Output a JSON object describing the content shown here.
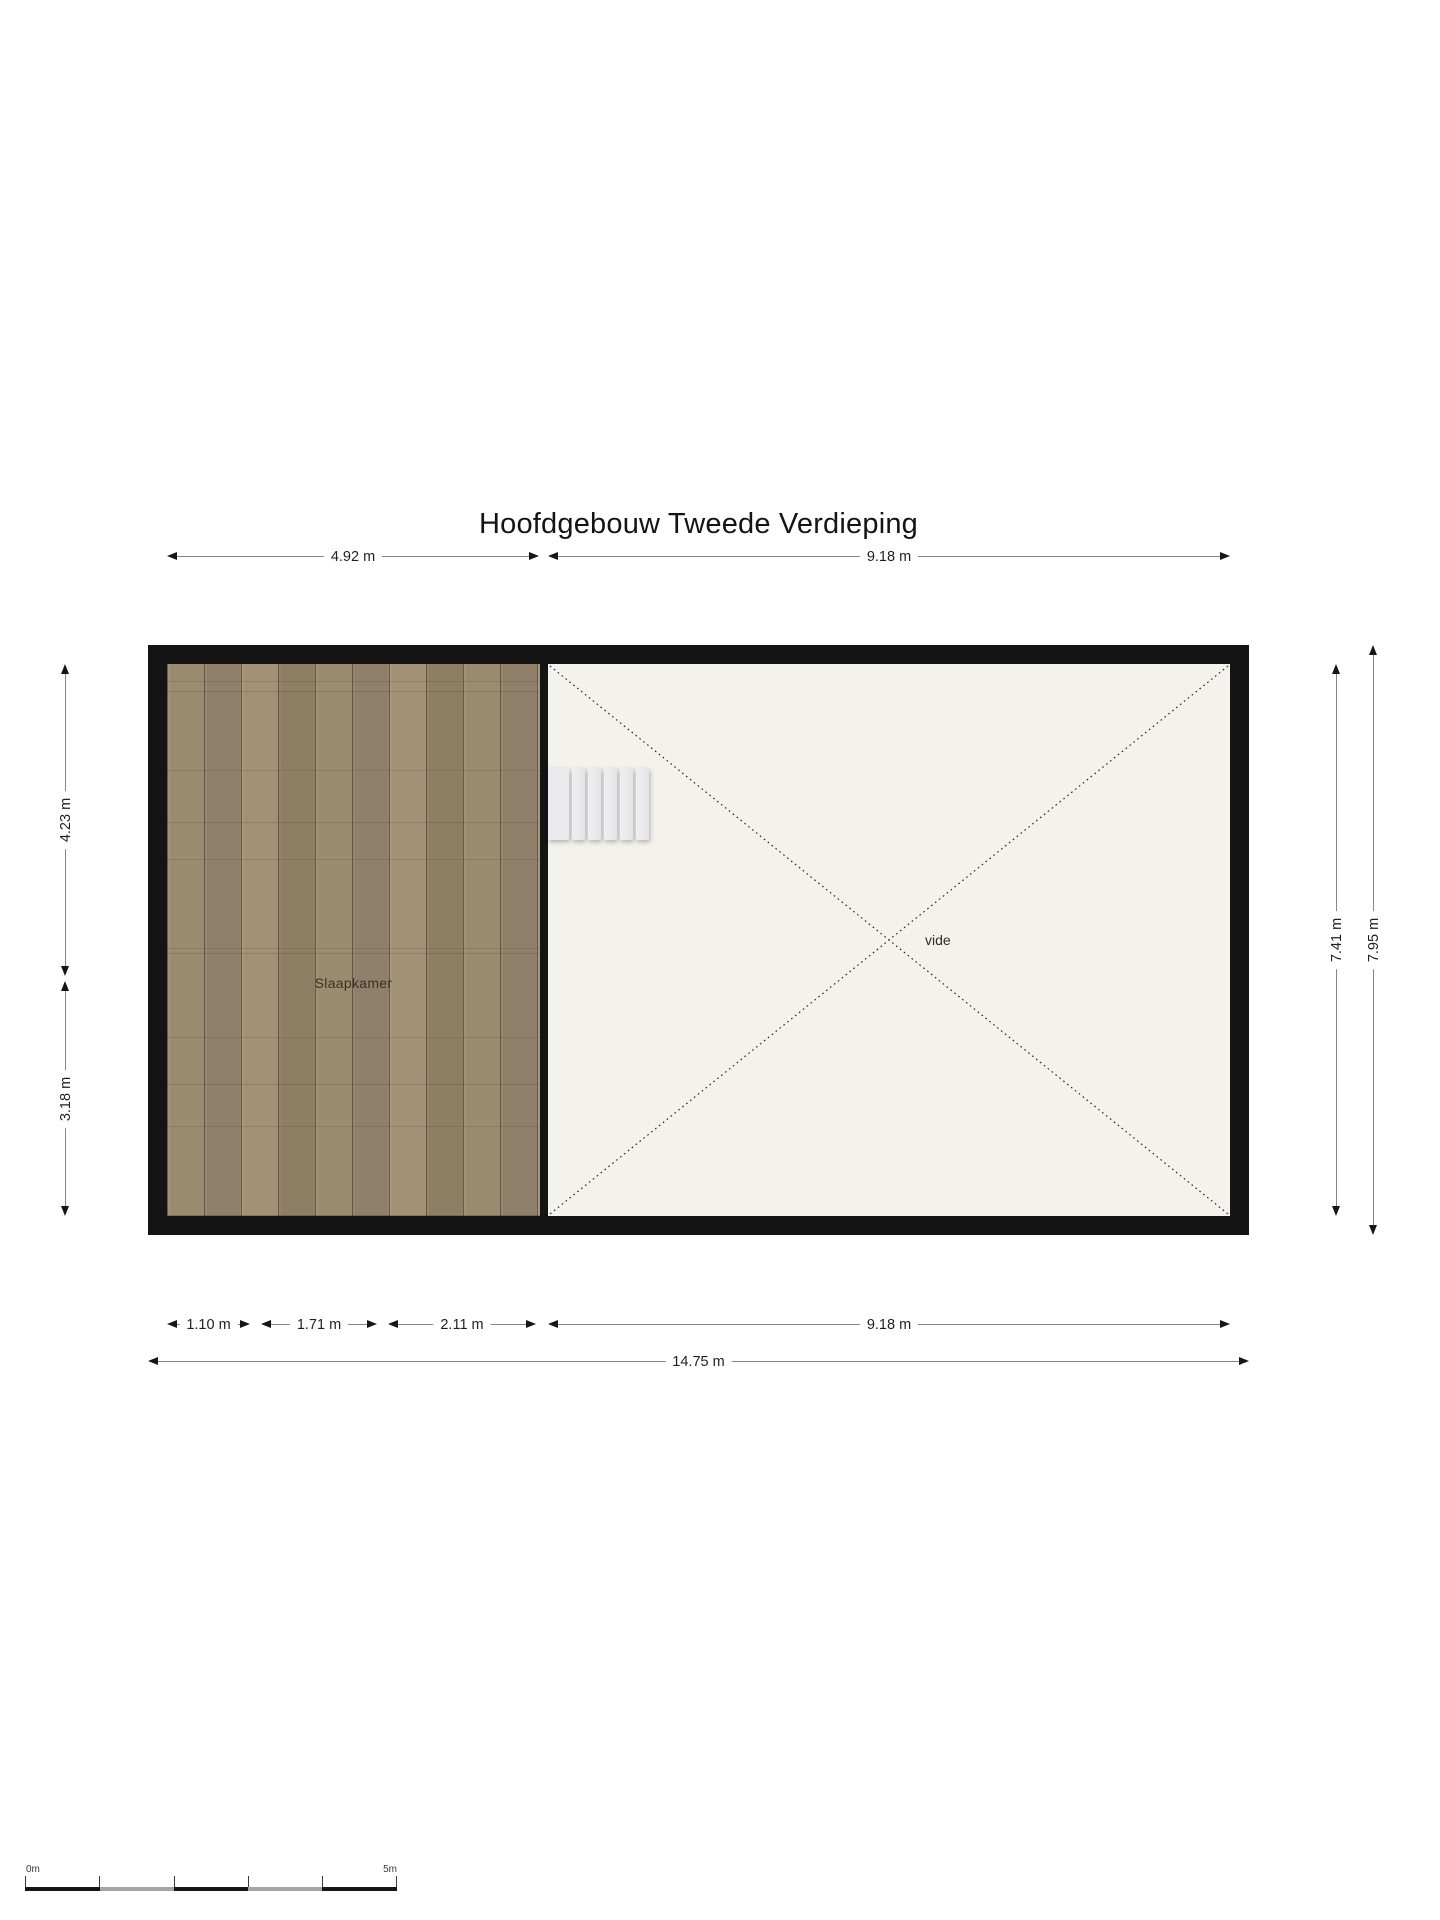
{
  "title": "Hoofdgebouw Tweede Verdieping",
  "rooms": {
    "slaapkamer": {
      "label": "Slaapkamer"
    },
    "vide": {
      "label": "vide"
    }
  },
  "dimensions": {
    "top": [
      {
        "label": "4.92 m"
      },
      {
        "label": "9.18 m"
      }
    ],
    "left": [
      {
        "label": "4.23 m"
      },
      {
        "label": "3.18 m"
      }
    ],
    "right": [
      {
        "label": "7.41 m"
      },
      {
        "label": "7.95 m"
      }
    ],
    "bottom": [
      {
        "label": "1.10 m"
      },
      {
        "label": "1.71 m"
      },
      {
        "label": "2.11 m"
      },
      {
        "label": "9.18 m"
      }
    ],
    "total_width": {
      "label": "14.75 m"
    }
  },
  "scale_bar": {
    "start": "0m",
    "end": "5m"
  },
  "colors": {
    "wall": "#141414",
    "wood_floor": "#98886b",
    "vide_floor": "#f4f2ec",
    "dimension_line": "#878787",
    "arrow_and_text": "#161616"
  }
}
